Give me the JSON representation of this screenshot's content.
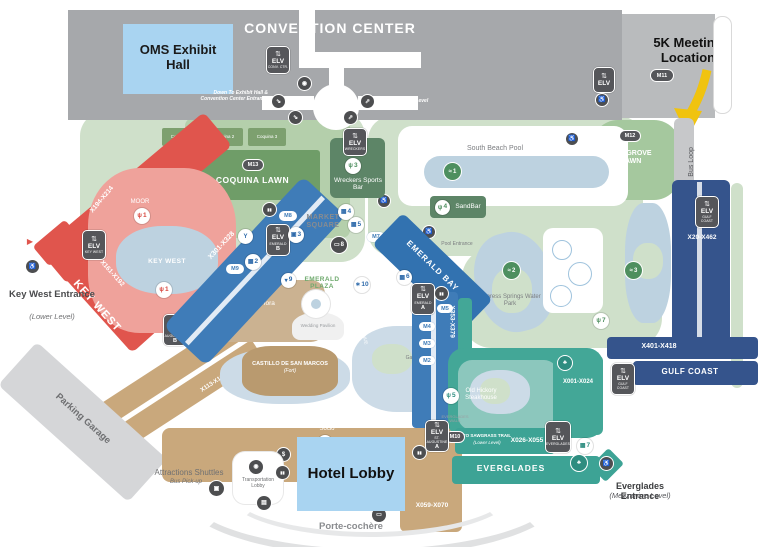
{
  "colors": {
    "convention_gray": "#a6a8ab",
    "annex_gray": "#b9bbbd",
    "highlight_blue": "#a9d4f1",
    "arrow_yellow": "#f0c30f",
    "key_west_red": "#e0554d",
    "st_augustine_tan": "#c9a87c",
    "emerald_blue": "#3f7cb8",
    "gulf_navy": "#35548c",
    "everglades_teal": "#3da395",
    "lawn_green": "#cfe0ca",
    "pool_blue": "#bdd2e0"
  },
  "convention": {
    "title": "CONVENTION CENTER",
    "oms": "OMS Exhibit Hall",
    "meeting5k": "5K Meeting Location",
    "down_note": "Down To Exhibit Hall & Convention Center Entrance",
    "up_note": "Up To Ballroom Level",
    "bus_loop": "Bus Loop"
  },
  "lawns": {
    "coquina": "COQUINA LAWN",
    "coquina1": "Coquina 1",
    "coquina2": "Coquina 2",
    "coquina3": "Coquina 3",
    "mangrove": "MANGROVE LAWN",
    "market_square": "MARKET SQUARE",
    "emerald_plaza": "EMERALD PLAZA"
  },
  "pools": {
    "south_beach": "South Beach Pool",
    "pool_entrance": "Pool Entrance",
    "cypress": "Cypress Springs Water Park",
    "gator": "Gator Springs",
    "key_west_pool": "KEY WEST"
  },
  "dining": {
    "moor": "MOOR",
    "wreckers": "Wreckers Sports Bar",
    "sandbar": "SandBar",
    "villa": "Villa de Flora",
    "old_hickory": "Old Hickory Steakhouse",
    "socio": "Socio"
  },
  "wings": {
    "key_west": "KEY WEST",
    "kw_r1": "X194-X214",
    "kw_r2": "X161-X192",
    "st_augustine": "ST. AUGUSTINE",
    "sa_r1": "X113-X160",
    "sa_r2": "X059-X070",
    "emerald_r1": "X301-X328",
    "emerald_bay": "EMERALD BAY",
    "emerald_r2": "X353-X379",
    "everglades": "EVERGLADES",
    "ev_r1": "X001-X024",
    "ev_r2": "X026-X055",
    "sawgrass": "TO SAWGRASS TRAIL",
    "sawgrass_sub": "(Lower Level)",
    "gulf_coast": "GULF COAST",
    "gc_r1": "X20-X462",
    "gc_r2": "X401-X418"
  },
  "landmarks": {
    "hotel_lobby": "Hotel Lobby",
    "porte": "Porte-cochère",
    "castillo": "CASTILLO DE SAN MARCOS",
    "castillo_sub": "(Fort)",
    "wedding": "Wedding Pavilion",
    "parking": "Parking Garage",
    "transportation": "Transportation Lobby",
    "shuttles": "Attractions Shuttles",
    "shuttles_sub": "Bus Pick-up"
  },
  "entrances": {
    "kw": "Key West Entrance",
    "kw_sub": "(Lower Level)",
    "ev": "Everglades Entrance",
    "ev_sub": "(Mezzanine Level)"
  },
  "streets": {
    "gause": "GAUSE AVENUE",
    "st_george": "ST. GEORGE STREET",
    "kw_way": "KEY WEST WAY",
    "ev_walk": "EVERGLADES WALK"
  },
  "elv": {
    "label": "ELV",
    "conv": "CONV. CTR.",
    "wreckers": "WRECKERS",
    "key_west": "KEY WEST",
    "emerald": "EMERALD",
    "st_augustine": "ST. AUGUSTINE",
    "everglades": "EVERGLADES",
    "gulf": "GULF COAST",
    "a": "A",
    "b": "B"
  },
  "pills": {
    "m2": "M2",
    "m3": "M3",
    "m4": "M4",
    "m5": "M5",
    "m6": "M6",
    "m7": "M7",
    "m8": "M8",
    "m9": "M9",
    "m10": "M10",
    "m11": "M11",
    "m12": "M12",
    "m13": "M13"
  },
  "markers": {
    "d1": "1",
    "d2": "2",
    "d3": "3",
    "d4": "4",
    "d5": "5",
    "d7": "7",
    "p1": "1",
    "p2": "2",
    "p3": "3",
    "v2": "2",
    "v4": "4",
    "v5": "5",
    "v6": "6",
    "v7": "7",
    "av8": "8",
    "t9": "9",
    "f10": "10",
    "s3": "3"
  },
  "glyphs": {
    "fork": "ψ",
    "swim": "≈",
    "building": "▦",
    "gift": "▣",
    "screen": "▭",
    "treat": "▾",
    "fan": "∗",
    "palm": "♣",
    "elevator": "⇅",
    "access": "♿",
    "bus": "▣",
    "bell": "◉",
    "restroom": "▮▮",
    "dollar": "$",
    "luggage": "▤",
    "car": "▭",
    "drink": "Y",
    "esc_down": "⇘",
    "esc_up": "⇗",
    "arrow_right": "▶"
  }
}
